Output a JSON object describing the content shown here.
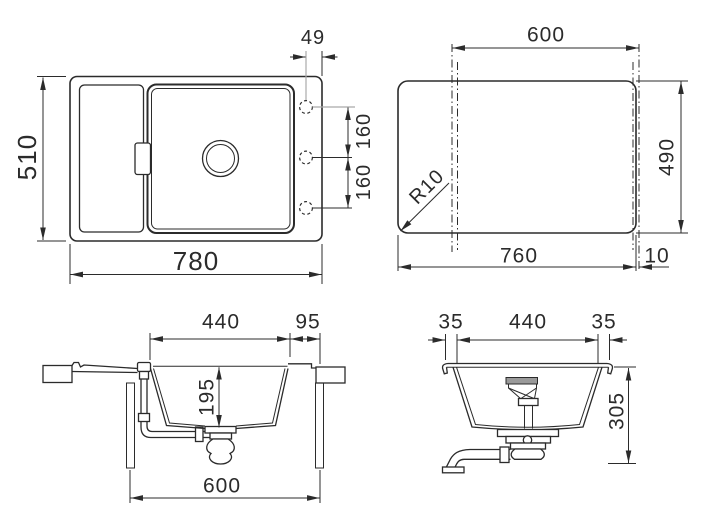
{
  "drawing": {
    "type": "sink-installation-technical-drawing",
    "views": [
      "top-plan",
      "worktop-cutout",
      "front-section",
      "side-section"
    ]
  },
  "colors": {
    "line_color": "#2b2b2b",
    "gray_line_color": "#a9a9a9",
    "fitting_gray": "#9a9a9a",
    "background": "#ffffff"
  },
  "views": {
    "top_view": {
      "width_49": "49",
      "height_510": "510",
      "width_780": "780",
      "spacing_160_a": "160",
      "spacing_160_b": "160"
    },
    "cutout_view": {
      "width_600": "600",
      "height_490": "490",
      "width_760": "760",
      "offset_10": "10",
      "corner_radius": "R10"
    },
    "front_section": {
      "bowl_width_440": "440",
      "offset_95": "95",
      "depth_195": "195",
      "cabinet_600": "600"
    },
    "side_section": {
      "offset_35_left": "35",
      "bowl_440": "440",
      "offset_35_right": "35",
      "depth_305": "305"
    }
  }
}
